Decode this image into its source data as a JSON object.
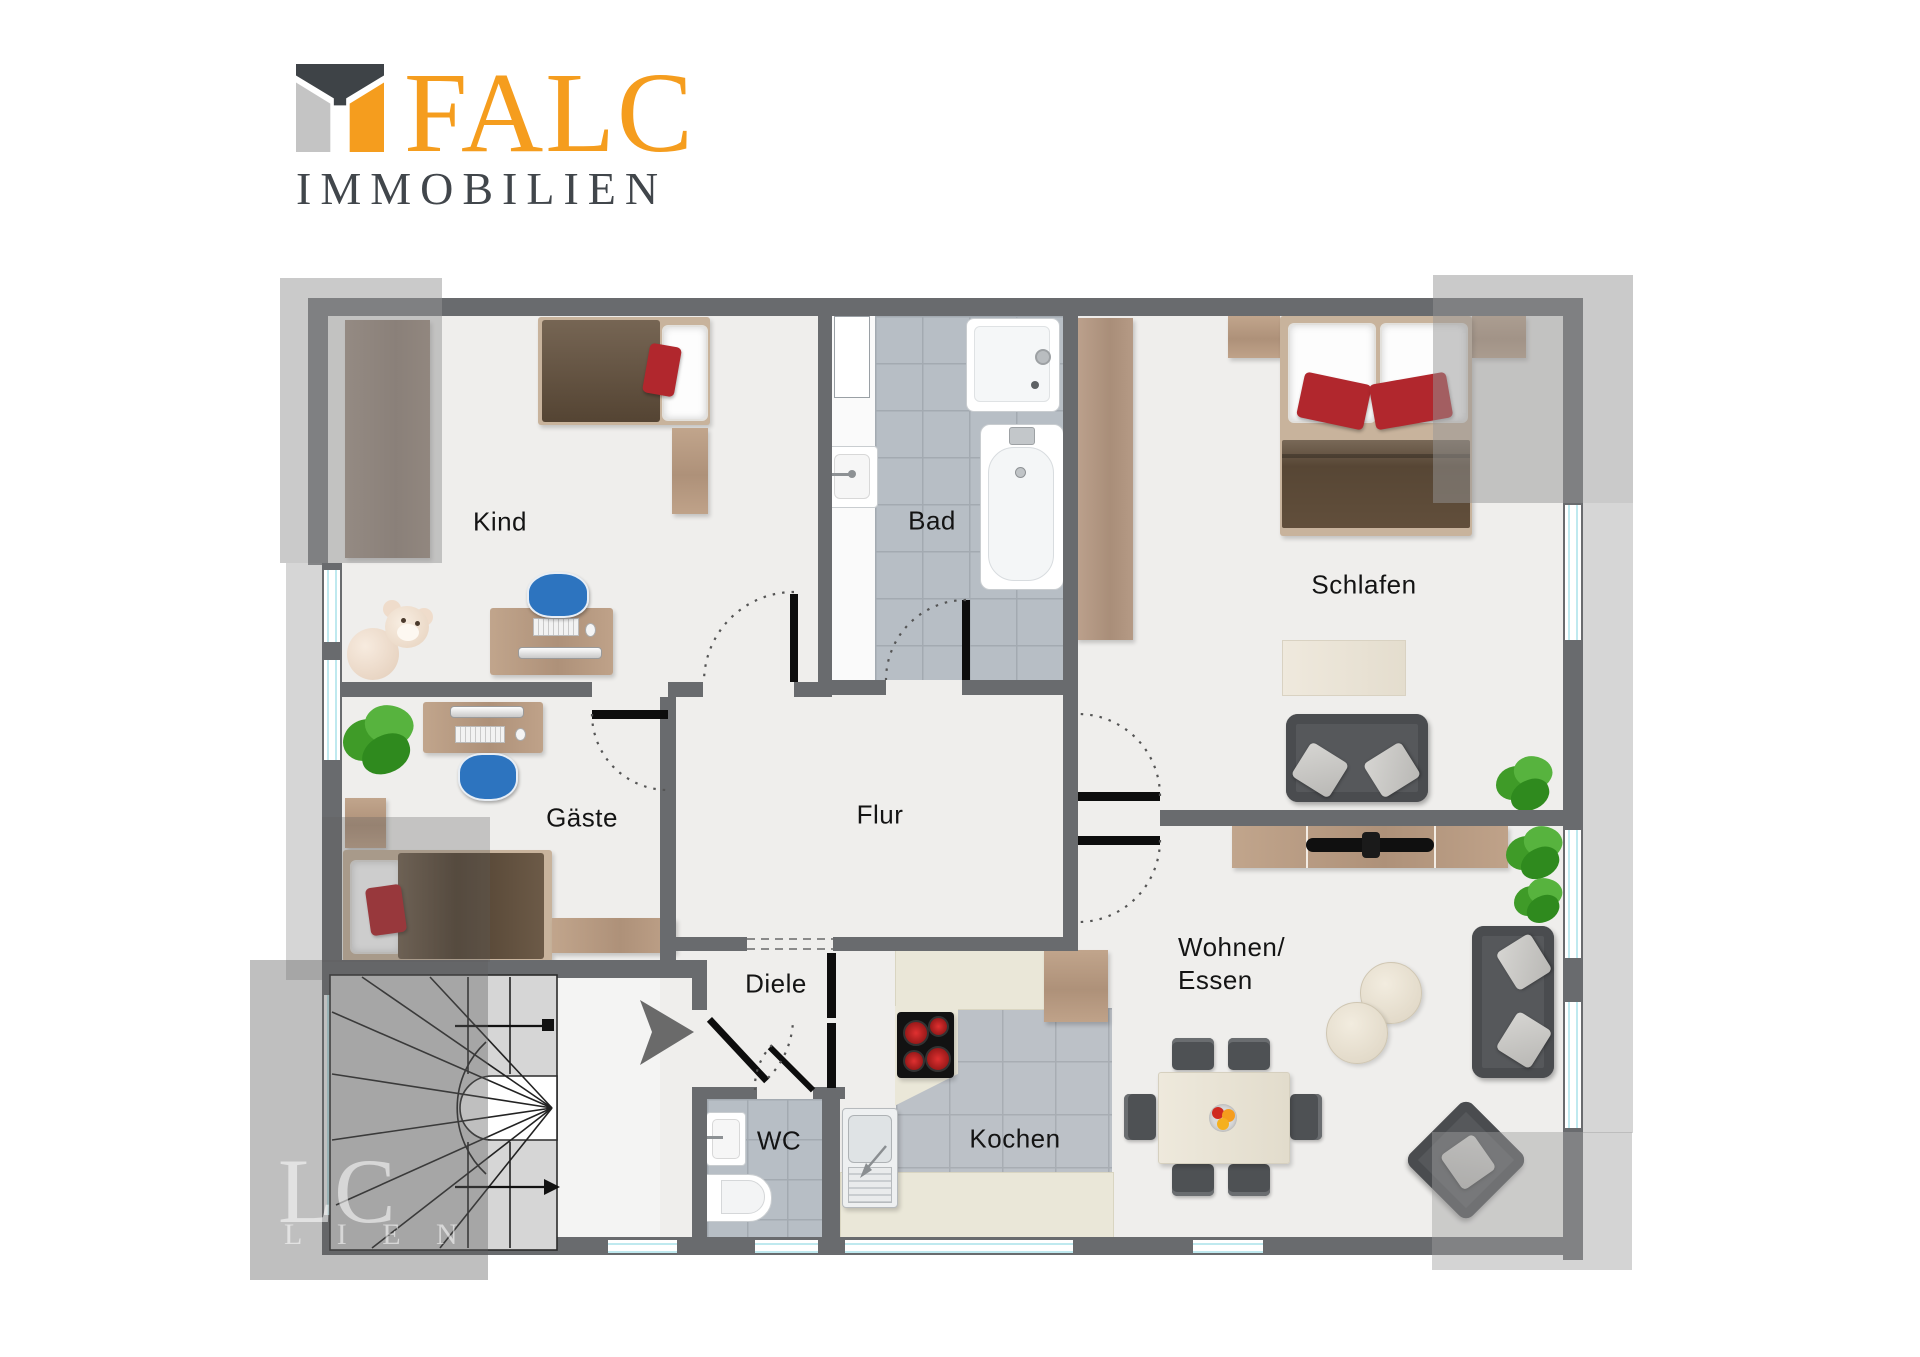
{
  "brand": {
    "name": "FALC",
    "subtitle": "IMMOBILIEN",
    "logo_orange": "#f59d1e",
    "logo_dark": "#3e4347",
    "logo_gray": "#c4c4c4"
  },
  "rooms": {
    "kind": "Kind",
    "bad": "Bad",
    "schlafen": "Schlafen",
    "gaeste": "Gäste",
    "flur": "Flur",
    "diele": "Diele",
    "wc": "WC",
    "kochen": "Kochen",
    "wohnen_line1": "Wohnen/",
    "wohnen_line2": "Essen"
  },
  "watermark": {
    "big": "LC",
    "small": "L I E N"
  },
  "colors": {
    "wall": "#696b6e",
    "floor": "#efeeec",
    "bath_tile": "#b7bec5",
    "kitchen_tile": "#bcc1c7",
    "wood": "#b59a82",
    "wardrobe": "#8a7668",
    "duvet": "#63503c",
    "accent_cushion": "#b1272d",
    "chair_blue": "#2d74bf",
    "sofa_gray": "#56585b",
    "window_glass": "#bfe9ef",
    "plant_green": "#3f9b28",
    "cream": "#eae7d8"
  }
}
